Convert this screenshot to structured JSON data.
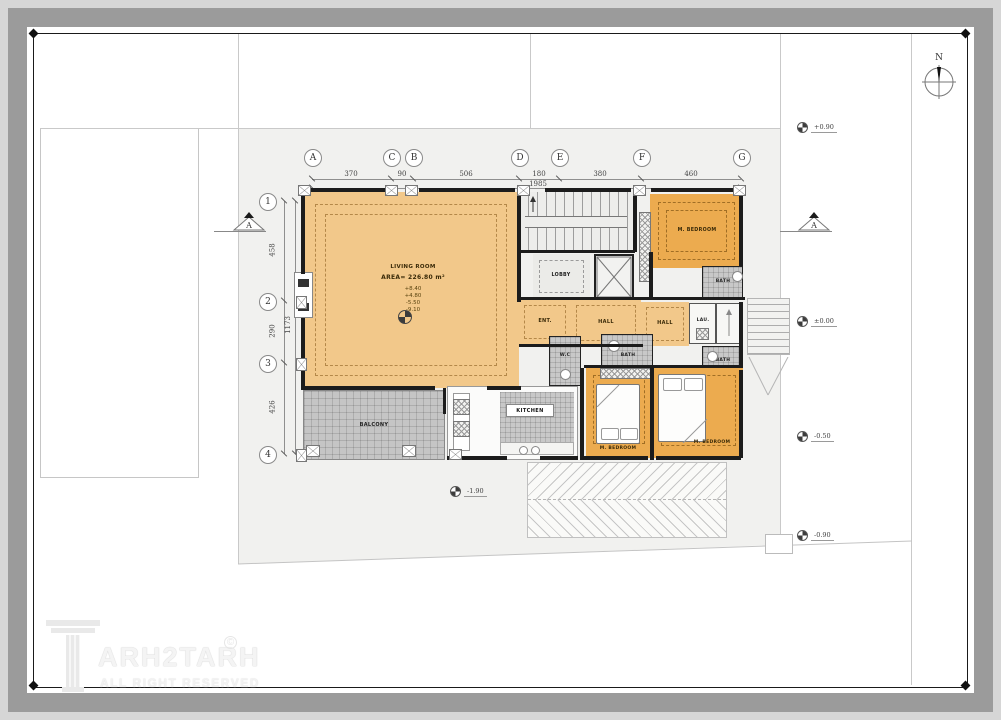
{
  "title": "Residential floor plan sheet",
  "compass": {
    "label": "N"
  },
  "grid": {
    "columns": [
      {
        "label": "A"
      },
      {
        "label": "C"
      },
      {
        "label": "B"
      },
      {
        "label": "D"
      },
      {
        "label": "E"
      },
      {
        "label": "F"
      },
      {
        "label": "G"
      }
    ],
    "rows": [
      {
        "label": "1"
      },
      {
        "label": "2"
      },
      {
        "label": "3"
      },
      {
        "label": "4"
      }
    ],
    "top_dims": [
      "370",
      "90",
      "506",
      "180",
      "380",
      "460"
    ],
    "top_total": "1985",
    "left_dims": [
      "458",
      "290",
      "426"
    ],
    "left_total": "1173"
  },
  "levels": [
    {
      "label": "+0.90"
    },
    {
      "label": "±0.00"
    },
    {
      "label": "-0.50"
    },
    {
      "label": "-0.90"
    },
    {
      "label": "-1.90"
    }
  ],
  "sections": [
    {
      "label": "A"
    },
    {
      "label": "A"
    }
  ],
  "rooms": {
    "living": {
      "name": "LIVING ROOM",
      "area": "AREA= 226.80 m²",
      "levels": [
        "+8.40",
        "+4.80",
        "-5.50",
        "-9.10"
      ]
    },
    "lobby": "LOBBY",
    "ent": "ENT.",
    "hall1": "HALL",
    "hall2": "HALL",
    "lau": "LAU.",
    "wc": "W.C",
    "bath1": "BATH",
    "bath2": "BATH",
    "bath3": "BATH",
    "kitchen": "KITCHEN",
    "balcony": "BALCONY",
    "bedroom1": "M. BEDROOM",
    "bedroom2": "M. BEDROOM",
    "bedroom3": "M. BEDROOM"
  },
  "watermark": {
    "brand": "ARH2TARH",
    "copyright": "©",
    "tagline": "ALL RIGHT RESERVED"
  },
  "colors": {
    "room_tan": "#f2c88a",
    "room_orange": "#ecab4f",
    "site": "#f1f1ef",
    "wall": "#1c1c1c",
    "paper": "#ffffff"
  }
}
